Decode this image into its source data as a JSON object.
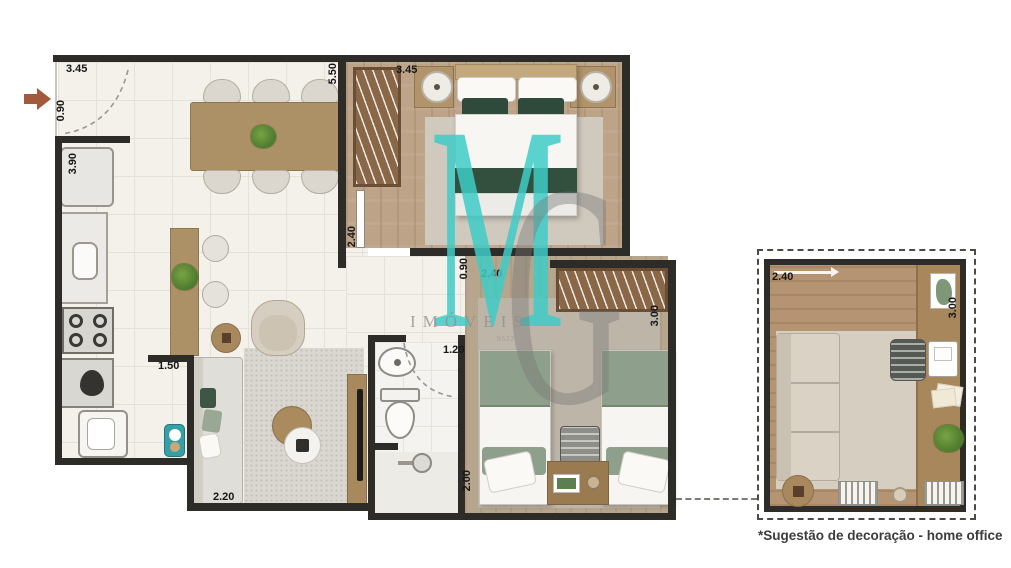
{
  "caption": {
    "office_note": "*Sugestão de decoração - home office"
  },
  "watermark": {
    "letter_m": "M",
    "letter_g": "G",
    "brand": "IMÓVEIS",
    "registry_number": "9522"
  },
  "dimensions": {
    "entry_width": "3.45",
    "entry_depth": "0.90",
    "kitchen_length": "3.90",
    "living_length": "5.50",
    "bedroom1_width": "3.45",
    "bedroom1_depth": "2.40",
    "bedroom2_door_width": "0.90",
    "bedroom2_width": "2.40",
    "bedroom2_depth": "3.00",
    "bathroom_width": "1.20",
    "bathroom_depth": "2.00",
    "service_width": "1.50",
    "living_width": "2.20",
    "home_office_width": "2.40",
    "home_office_depth": "3.00"
  },
  "colors": {
    "accent_teal": "#3ecbc6",
    "wall": "#2e2c29",
    "wood": "#ad9166",
    "entry_arrow": "#a3593b",
    "bed_dark_green": "#33503e",
    "sage_green": "#8ea08b"
  }
}
